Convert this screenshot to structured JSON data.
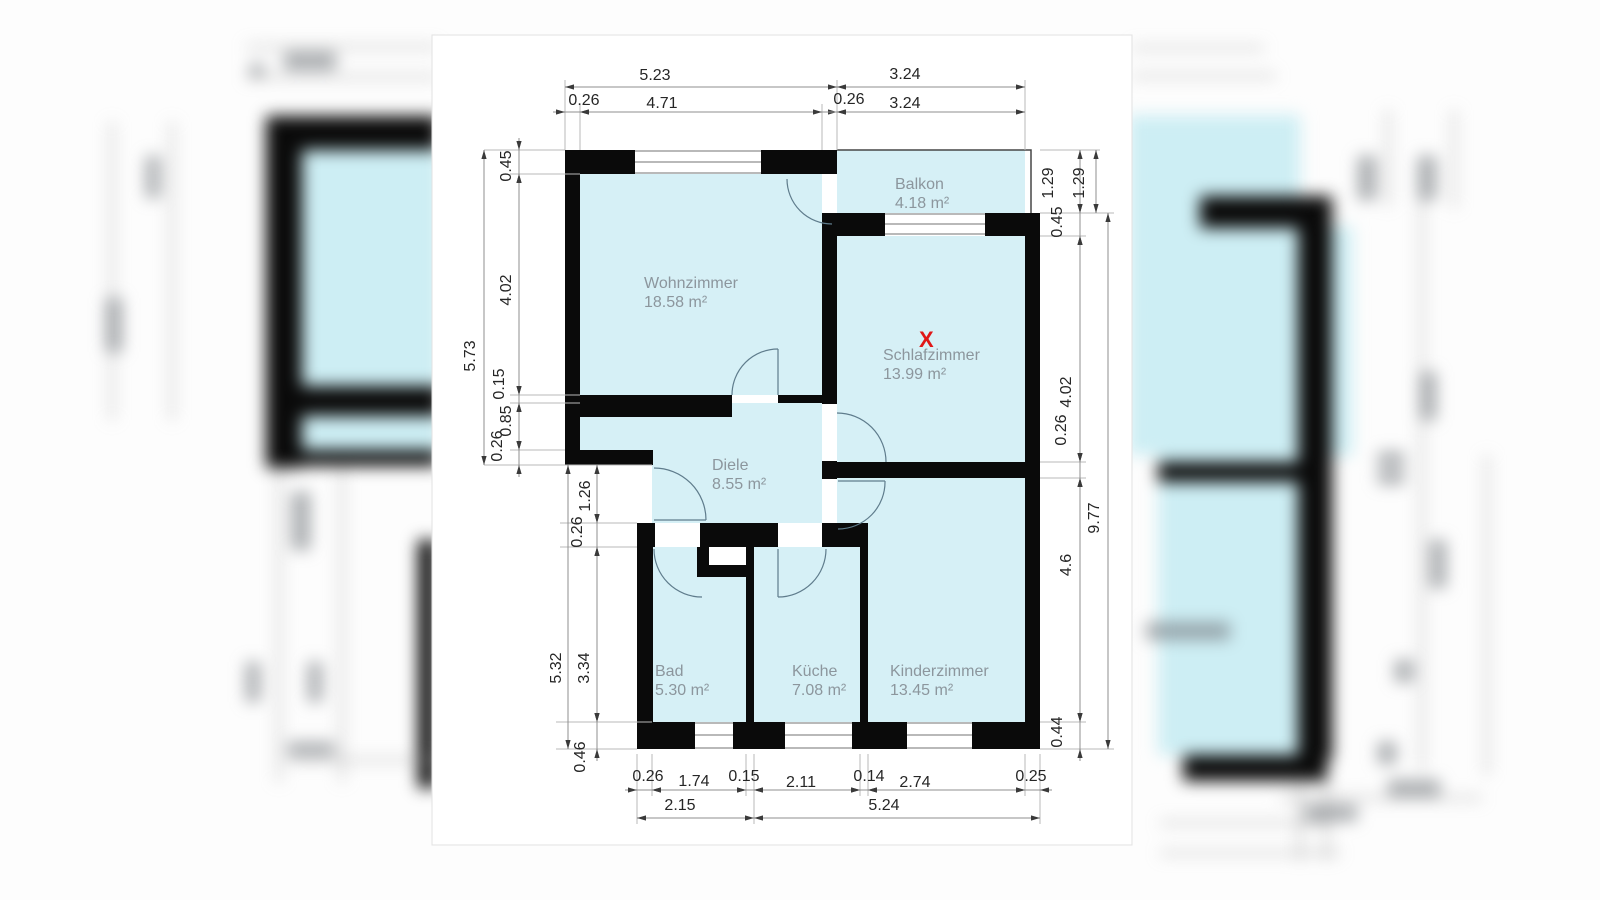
{
  "colors": {
    "canvas": "#ffffff",
    "room_fill": "#d6f0f6",
    "wall": "#0a0a0a",
    "dim_line": "#8f8f8f",
    "extension_line": "#b8b8b8",
    "arrow": "#3a3a3a",
    "dim_text": "#262626",
    "room_text": "#8c969d",
    "marker": "#e01717",
    "door_arc": "#5f7c8c",
    "window_line": "#8f8f8f",
    "balcony_line": "#474747"
  },
  "floor_plan": {
    "rooms": [
      {
        "id": "wohnzimmer",
        "name": "Wohnzimmer",
        "area": "18.58 m²"
      },
      {
        "id": "balkon",
        "name": "Balkon",
        "area": "4.18 m²"
      },
      {
        "id": "schlafzimmer",
        "name": "Schlafzimmer",
        "area": "13.99 m²"
      },
      {
        "id": "diele",
        "name": "Diele",
        "area": "8.55 m²"
      },
      {
        "id": "bad",
        "name": "Bad",
        "area": "5.30 m²"
      },
      {
        "id": "kueche",
        "name": "Küche",
        "area": "7.08 m²"
      },
      {
        "id": "kinderzimmer",
        "name": "Kinderzimmer",
        "area": "13.45 m²"
      }
    ],
    "marker": {
      "text": "X"
    },
    "dimensions": {
      "top": [
        "5.23",
        "3.24",
        "0.26",
        "4.71",
        "0.26",
        "3.24"
      ],
      "left": [
        "0.45",
        "4.02",
        "5.73",
        "0.15",
        "0.85",
        "0.26",
        "1.26",
        "0.26",
        "5.32",
        "3.34",
        "0.46"
      ],
      "right": [
        "1.29",
        "1.29",
        "0.45",
        "4.02",
        "0.26",
        "9.77",
        "4.6",
        "0.44"
      ],
      "bottom": [
        "0.26",
        "1.74",
        "0.15",
        "2.11",
        "0.14",
        "2.74",
        "0.25",
        "2.15",
        "5.24"
      ]
    }
  }
}
